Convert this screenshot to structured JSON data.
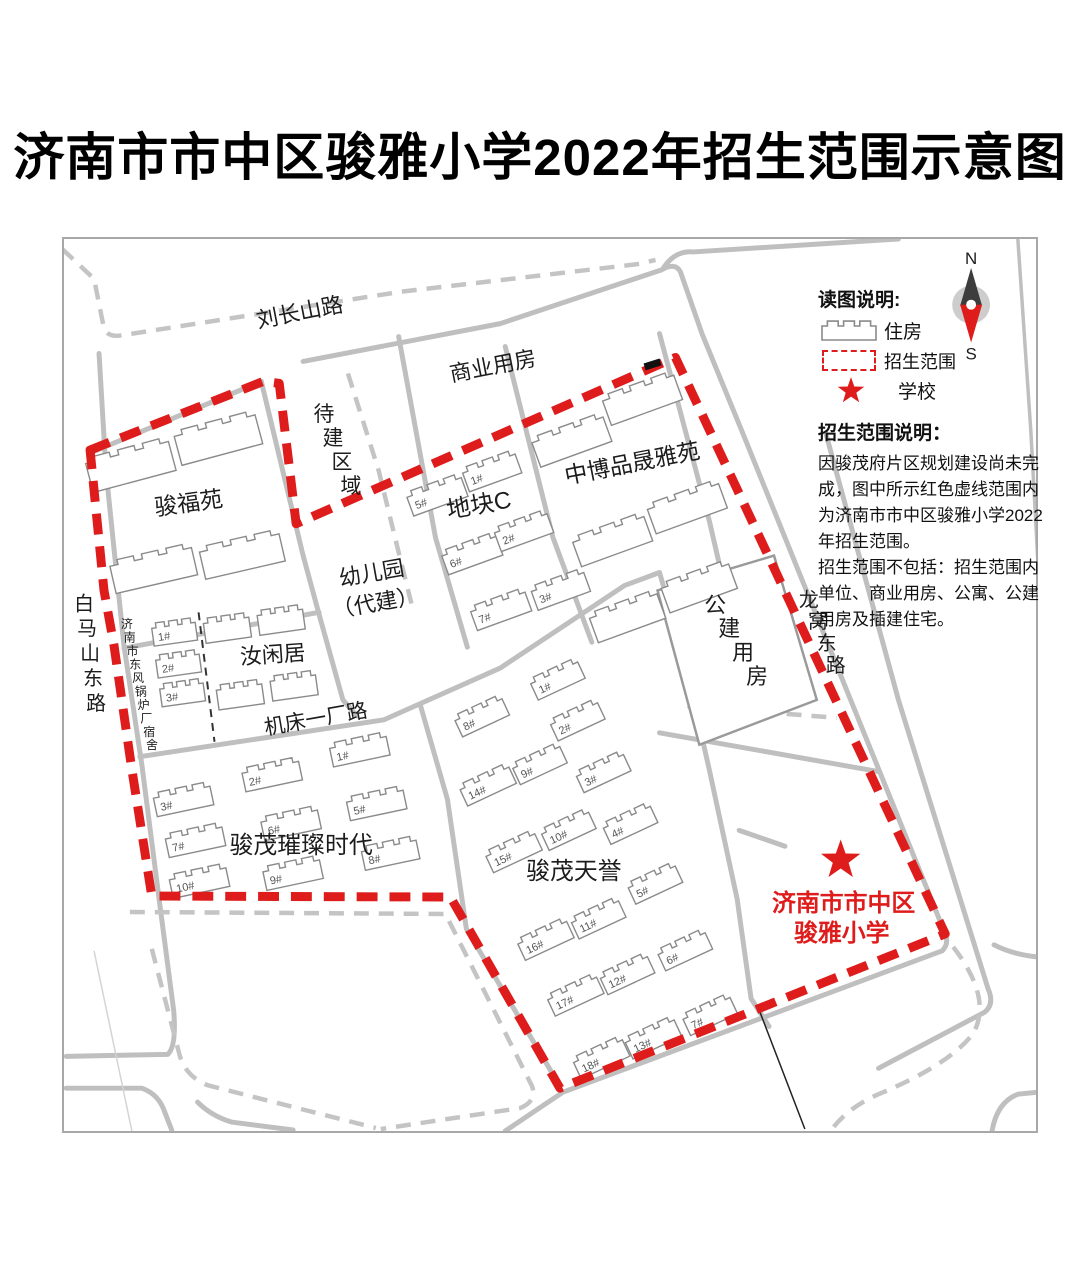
{
  "title": "济南市市中区骏雅小学2022年招生范围示意图",
  "legend": {
    "title": "读图说明:",
    "housing_label": "住房",
    "range_label": "招生范围",
    "school_label": "学校"
  },
  "compass": {
    "north": "N",
    "south": "S"
  },
  "note": {
    "title": "招生范围说明：",
    "lines": [
      "因骏茂府片区规划建设尚未完",
      "成，图中所示红色虚线范围内",
      "为济南市市中区骏雅小学2022",
      "年招生范围。",
      "招生范围不包括：招生范围内",
      "单位、商业用房、公寓、公建",
      "用房及插建住宅。"
    ]
  },
  "school": {
    "name_line1": "济南市市中区",
    "name_line2": "骏雅小学"
  },
  "map": {
    "accent_red": "#df1c1c",
    "road_gray": "#bfbfbf",
    "labels": [
      {
        "n": "road-liuchangshan-label",
        "t": "刘长山路",
        "x": 300,
        "y": 318,
        "s": 22,
        "r": -11
      },
      {
        "n": "area-shangyeyongfang-label",
        "t": "商业用房",
        "x": 494,
        "y": 372,
        "s": 22,
        "r": -11
      },
      {
        "n": "area-junfuyuan-label",
        "t": "骏福苑",
        "x": 188,
        "y": 510,
        "s": 23,
        "r": -8
      },
      {
        "n": "area-dikuaic-label",
        "t": "地块C",
        "x": 480,
        "y": 512,
        "s": 24,
        "r": -10
      },
      {
        "n": "area-zhongbo-label",
        "t": "中博品晟雅苑",
        "x": 634,
        "y": 470,
        "s": 23,
        "r": -11
      },
      {
        "n": "area-youeryuan-label-1",
        "t": "幼儿园",
        "x": 372,
        "y": 580,
        "s": 22,
        "r": -10
      },
      {
        "n": "area-youeryuan-label-2",
        "t": "（代建）",
        "x": 376,
        "y": 610,
        "s": 22,
        "r": -10
      },
      {
        "n": "area-ruxianju-label",
        "t": "汝闲居",
        "x": 272,
        "y": 662,
        "s": 22,
        "r": -4
      },
      {
        "n": "road-jichuang-label",
        "t": "机床一厂路",
        "x": 316,
        "y": 726,
        "s": 21,
        "r": -10
      },
      {
        "n": "area-cuican-label",
        "t": "骏茂璀璨时代",
        "x": 300,
        "y": 854,
        "s": 24,
        "r": 0
      },
      {
        "n": "area-tianyu-label",
        "t": "骏茂天誉",
        "x": 574,
        "y": 880,
        "s": 24,
        "r": 0
      },
      {
        "n": "school-name-line1",
        "t": "济南市市中区",
        "x": 845,
        "y": 912,
        "s": 24,
        "r": 0,
        "c": "#df1c1c",
        "b": 1
      },
      {
        "n": "school-name-line2",
        "t": "骏雅小学",
        "x": 843,
        "y": 942,
        "s": 24,
        "r": 0,
        "c": "#df1c1c",
        "b": 1
      }
    ],
    "vlabels": [
      {
        "n": "road-baimashandong-label",
        "t": "白马山东路",
        "x": 82,
        "y": 610,
        "s": 20,
        "step": 25,
        "drift": 3
      },
      {
        "n": "area-guoluchang-label",
        "t": "济南市东风锅炉厂宿舍",
        "x": 125,
        "y": 628,
        "s": 12,
        "step": 13.5,
        "drift": 2.8
      },
      {
        "n": "area-daijianquyu-label",
        "t": "待建区域",
        "x": 323,
        "y": 420,
        "s": 21,
        "step": 24,
        "drift": 9
      },
      {
        "n": "road-longwodong-label",
        "t": "龙窝东路",
        "x": 810,
        "y": 606,
        "s": 20,
        "step": 22,
        "drift": 9
      },
      {
        "n": "area-gongjianyongfang-label",
        "t": "公建用房",
        "x": 716,
        "y": 612,
        "s": 22,
        "step": 24,
        "drift": 14
      }
    ],
    "buildings": [
      {
        "a": "骏福苑",
        "l": "",
        "x": 129,
        "y": 466,
        "w": 86,
        "h": 30,
        "r": -15
      },
      {
        "a": "骏福苑",
        "l": "",
        "x": 217,
        "y": 439,
        "w": 84,
        "h": 30,
        "r": -15
      },
      {
        "a": "骏福苑",
        "l": "",
        "x": 152,
        "y": 570,
        "w": 84,
        "h": 28,
        "r": -13
      },
      {
        "a": "骏福苑",
        "l": "",
        "x": 241,
        "y": 556,
        "w": 82,
        "h": 28,
        "r": -13
      },
      {
        "a": "济南市东风锅炉厂宿舍",
        "l": "1#",
        "x": 173,
        "y": 634,
        "w": 44,
        "h": 18,
        "r": -8
      },
      {
        "a": "济南市东风锅炉厂宿舍",
        "l": "2#",
        "x": 177,
        "y": 666,
        "w": 44,
        "h": 18,
        "r": -8
      },
      {
        "a": "济南市东风锅炉厂宿舍",
        "l": "3#",
        "x": 181,
        "y": 695,
        "w": 44,
        "h": 18,
        "r": -8
      },
      {
        "a": "汝闲居",
        "l": "",
        "x": 226,
        "y": 630,
        "w": 46,
        "h": 20,
        "r": -8
      },
      {
        "a": "汝闲居",
        "l": "",
        "x": 280,
        "y": 622,
        "w": 46,
        "h": 20,
        "r": -8
      },
      {
        "a": "汝闲居",
        "l": "",
        "x": 239,
        "y": 697,
        "w": 46,
        "h": 20,
        "r": -8
      },
      {
        "a": "汝闲居",
        "l": "",
        "x": 293,
        "y": 688,
        "w": 46,
        "h": 20,
        "r": -8
      },
      {
        "a": "地块C",
        "l": "5#",
        "x": 437,
        "y": 496,
        "w": 58,
        "h": 20,
        "r": -20
      },
      {
        "a": "地块C",
        "l": "1#",
        "x": 492,
        "y": 472,
        "w": 56,
        "h": 20,
        "r": -20
      },
      {
        "a": "地块C",
        "l": "6#",
        "x": 472,
        "y": 555,
        "w": 58,
        "h": 20,
        "r": -20
      },
      {
        "a": "地块C",
        "l": "2#",
        "x": 524,
        "y": 532,
        "w": 56,
        "h": 20,
        "r": -20
      },
      {
        "a": "地块C",
        "l": "7#",
        "x": 501,
        "y": 611,
        "w": 58,
        "h": 20,
        "r": -20
      },
      {
        "a": "地块C",
        "l": "3#",
        "x": 561,
        "y": 591,
        "w": 56,
        "h": 20,
        "r": -20
      },
      {
        "a": "中博品晟雅苑",
        "l": "",
        "x": 572,
        "y": 441,
        "w": 76,
        "h": 26,
        "r": -20
      },
      {
        "a": "中博品晟雅苑",
        "l": "",
        "x": 643,
        "y": 399,
        "w": 76,
        "h": 26,
        "r": -20
      },
      {
        "a": "中博品晟雅苑",
        "l": "",
        "x": 613,
        "y": 541,
        "w": 76,
        "h": 26,
        "r": -20
      },
      {
        "a": "中博品晟雅苑",
        "l": "",
        "x": 688,
        "y": 508,
        "w": 76,
        "h": 26,
        "r": -20
      },
      {
        "a": "中博品晟雅苑",
        "l": "",
        "x": 628,
        "y": 618,
        "w": 72,
        "h": 26,
        "r": -20
      },
      {
        "a": "中博品晟雅苑",
        "l": "",
        "x": 700,
        "y": 588,
        "w": 72,
        "h": 26,
        "r": -20
      },
      {
        "a": "骏茂璀璨时代",
        "l": "1#",
        "x": 359,
        "y": 752,
        "w": 58,
        "h": 19,
        "r": -12
      },
      {
        "a": "骏茂璀璨时代",
        "l": "2#",
        "x": 271,
        "y": 777,
        "w": 58,
        "h": 19,
        "r": -12
      },
      {
        "a": "骏茂璀璨时代",
        "l": "3#",
        "x": 182,
        "y": 802,
        "w": 58,
        "h": 19,
        "r": -12
      },
      {
        "a": "骏茂璀璨时代",
        "l": "5#",
        "x": 376,
        "y": 806,
        "w": 58,
        "h": 19,
        "r": -12
      },
      {
        "a": "骏茂璀璨时代",
        "l": "6#",
        "x": 290,
        "y": 826,
        "w": 58,
        "h": 19,
        "r": -12
      },
      {
        "a": "骏茂璀璨时代",
        "l": "7#",
        "x": 194,
        "y": 843,
        "w": 58,
        "h": 19,
        "r": -12
      },
      {
        "a": "骏茂璀璨时代",
        "l": "8#",
        "x": 390,
        "y": 856,
        "w": 56,
        "h": 19,
        "r": -12
      },
      {
        "a": "骏茂璀璨时代",
        "l": "9#",
        "x": 292,
        "y": 876,
        "w": 58,
        "h": 19,
        "r": -12
      },
      {
        "a": "骏茂璀璨时代",
        "l": "10#",
        "x": 198,
        "y": 884,
        "w": 58,
        "h": 19,
        "r": -12
      },
      {
        "a": "骏茂天誉",
        "l": "1#",
        "x": 558,
        "y": 681,
        "w": 52,
        "h": 18,
        "r": -25
      },
      {
        "a": "骏茂天誉",
        "l": "8#",
        "x": 482,
        "y": 718,
        "w": 52,
        "h": 18,
        "r": -25
      },
      {
        "a": "骏茂天誉",
        "l": "2#",
        "x": 578,
        "y": 722,
        "w": 52,
        "h": 18,
        "r": -25
      },
      {
        "a": "骏茂天誉",
        "l": "9#",
        "x": 540,
        "y": 766,
        "w": 52,
        "h": 18,
        "r": -25
      },
      {
        "a": "骏茂天誉",
        "l": "3#",
        "x": 604,
        "y": 774,
        "w": 52,
        "h": 18,
        "r": -25
      },
      {
        "a": "骏茂天誉",
        "l": "14#",
        "x": 488,
        "y": 787,
        "w": 54,
        "h": 18,
        "r": -25
      },
      {
        "a": "骏茂天誉",
        "l": "10#",
        "x": 569,
        "y": 832,
        "w": 52,
        "h": 18,
        "r": -25
      },
      {
        "a": "骏茂天誉",
        "l": "4#",
        "x": 631,
        "y": 826,
        "w": 52,
        "h": 18,
        "r": -25
      },
      {
        "a": "骏茂天誉",
        "l": "15#",
        "x": 514,
        "y": 854,
        "w": 54,
        "h": 18,
        "r": -25
      },
      {
        "a": "骏茂天誉",
        "l": "5#",
        "x": 656,
        "y": 886,
        "w": 52,
        "h": 18,
        "r": -25
      },
      {
        "a": "骏茂天誉",
        "l": "11#",
        "x": 599,
        "y": 921,
        "w": 52,
        "h": 18,
        "r": -25
      },
      {
        "a": "骏茂天誉",
        "l": "16#",
        "x": 546,
        "y": 942,
        "w": 54,
        "h": 18,
        "r": -25
      },
      {
        "a": "骏茂天誉",
        "l": "6#",
        "x": 686,
        "y": 953,
        "w": 52,
        "h": 18,
        "r": -25
      },
      {
        "a": "骏茂天誉",
        "l": "12#",
        "x": 628,
        "y": 977,
        "w": 52,
        "h": 18,
        "r": -25
      },
      {
        "a": "骏茂天誉",
        "l": "17#",
        "x": 576,
        "y": 998,
        "w": 54,
        "h": 18,
        "r": -25
      },
      {
        "a": "骏茂天誉",
        "l": "7#",
        "x": 711,
        "y": 1018,
        "w": 52,
        "h": 18,
        "r": -25
      },
      {
        "a": "骏茂天誉",
        "l": "13#",
        "x": 654,
        "y": 1041,
        "w": 54,
        "h": 18,
        "r": -25
      },
      {
        "a": "骏茂天誉",
        "l": "18#",
        "x": 602,
        "y": 1061,
        "w": 54,
        "h": 18,
        "r": -25
      }
    ]
  }
}
